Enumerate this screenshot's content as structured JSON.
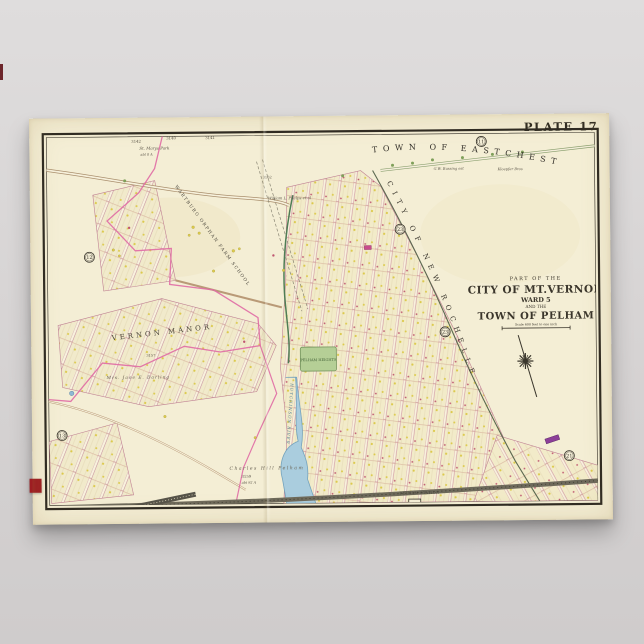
{
  "poster": {
    "plate_label": "PLATE 17",
    "title_block": {
      "line1": "PART OF THE",
      "line2": "CITY OF MT.VERNON",
      "line3": "WARD 5",
      "line4": "AND THE",
      "line5": "TOWN OF PELHAM",
      "scale_text": "Scale 600 feet to one inch"
    },
    "region_labels": {
      "eastchester": "TOWN OF EASTCHESTER",
      "new_rochelle": "CITY OF NEW ROCHELLE",
      "wartburg": "WARTBURG ORPHAN FARM SCHOOL",
      "manor": "VERNON MANOR",
      "river": "HUTCHINSON RIVER",
      "park": "PELHAM HEIGHTS",
      "station": "PELHAM STATION"
    },
    "plate_refs": {
      "top": "11",
      "left_upper": "12",
      "left_lower": "13",
      "right_upper": "23",
      "right_mid": "23",
      "right_lower": "21",
      "bottom_left": "16",
      "bottom_right": "18"
    },
    "annotations": {
      "st_marys": "St. Marys Park",
      "st_marys_acre": "abt 8 A",
      "bussing": "G.W. Bussing est",
      "kloepfer": "Kloepfer Bros",
      "phelps": "William L. Phelps et al",
      "darling": "Mrs. Jane E. Darling",
      "charles_hill": "Charles Hill Pelham",
      "acreage": "abt 92 A",
      "n3140": "3140",
      "n3141": "3141",
      "n3142": "3142",
      "n3157": "3157",
      "n3159": "3159",
      "n3162": "3162"
    },
    "colors": {
      "paper": "#f4eed5",
      "frame": "#2e2a22",
      "boundary_pink": "#e06aa4",
      "street_pink": "#ca8a9c",
      "water": "#aacdde",
      "park_green": "#b5cf96",
      "railroad": "#6e6a5b",
      "red_tab": "#9e1d22"
    }
  }
}
